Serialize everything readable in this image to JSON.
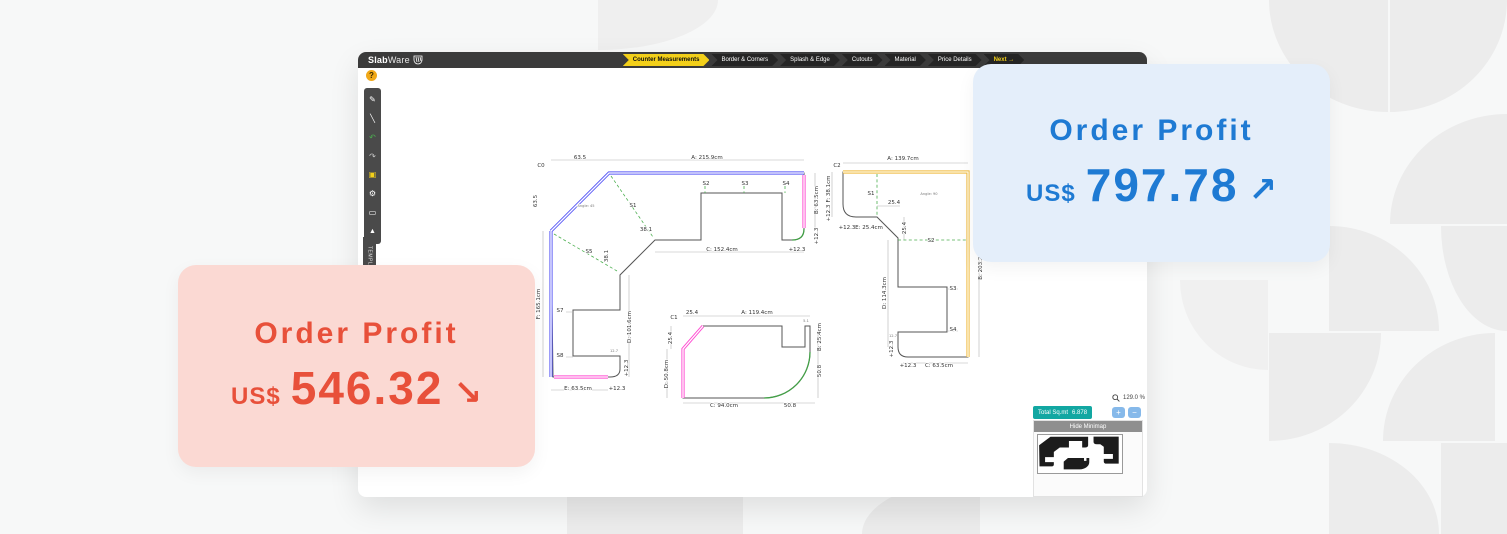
{
  "cards": {
    "red": {
      "title": "Order Profit",
      "currency": "US$",
      "amount": "546.32",
      "arrow": "↘"
    },
    "blue": {
      "title": "Order Profit",
      "currency": "US$",
      "amount": "797.78",
      "arrow": "↗"
    }
  },
  "topbar": {
    "logo_bold": "Slab",
    "logo_light": "Ware",
    "nav": [
      {
        "label": "Counter Measurements",
        "active": true
      },
      {
        "label": "Border & Corners",
        "active": false
      },
      {
        "label": "Splash & Edge",
        "active": false
      },
      {
        "label": "Cutouts",
        "active": false
      },
      {
        "label": "Material",
        "active": false
      },
      {
        "label": "Price Details",
        "active": false
      },
      {
        "label": "Next →",
        "active": false
      }
    ]
  },
  "toolbar": {
    "help": "?",
    "icons": [
      {
        "name": "pencil-icon",
        "glyph": "✎",
        "color": "#ffffff"
      },
      {
        "name": "draw-line-icon",
        "glyph": "╲",
        "color": "#ffffff"
      },
      {
        "name": "undo-icon",
        "glyph": "↶",
        "color": "#4caf50"
      },
      {
        "name": "redo-icon",
        "glyph": "↷",
        "color": "#cccccc"
      },
      {
        "name": "save-icon",
        "glyph": "▣",
        "color": "#f3d01a"
      },
      {
        "name": "settings-gear-icon",
        "glyph": "⚙",
        "color": "#ffffff"
      },
      {
        "name": "laptop-icon",
        "glyph": "▭",
        "color": "#ffffff"
      },
      {
        "name": "warning-icon",
        "glyph": "▲",
        "color": "#ffffff"
      }
    ]
  },
  "template_tab": "TEMPLATE",
  "controls": {
    "zoom_level": "129.0 %",
    "total_label": "Total Sq.mt",
    "total_value": "6.878",
    "zoom_in": "+",
    "zoom_out": "−",
    "minimap_header": "Hide Minimap"
  },
  "drawing": {
    "edge_colors": {
      "blue": "#5b5bf5",
      "pink": "#ff4dd2",
      "orange": "#efb93f",
      "green": "#43a047",
      "seam": "#4caf50"
    },
    "labels": [
      {
        "t": "C0",
        "x": 541,
        "y": 167
      },
      {
        "t": "63.5",
        "x": 580,
        "y": 159
      },
      {
        "t": "A: 215.9cm",
        "x": 707,
        "y": 159
      },
      {
        "t": "63.5",
        "x": 537,
        "y": 201,
        "r": -90
      },
      {
        "t": "F: 165.1cm",
        "x": 540,
        "y": 304,
        "r": -90
      },
      {
        "t": "Angle: 45",
        "x": 586,
        "y": 207,
        "tiny": true
      },
      {
        "t": "S1",
        "x": 633,
        "y": 207
      },
      {
        "t": "38.1",
        "x": 646,
        "y": 231
      },
      {
        "t": "S5",
        "x": 589,
        "y": 253
      },
      {
        "t": "38.1",
        "x": 608,
        "y": 256,
        "r": -90
      },
      {
        "t": "S2",
        "x": 706,
        "y": 185
      },
      {
        "t": "S3",
        "x": 745,
        "y": 185
      },
      {
        "t": "S4",
        "x": 786,
        "y": 185
      },
      {
        "t": "B: 63.5cm",
        "x": 818,
        "y": 200,
        "r": -90
      },
      {
        "t": "+12.3",
        "x": 818,
        "y": 236,
        "r": -90
      },
      {
        "t": "C: 152.4cm",
        "x": 722,
        "y": 251
      },
      {
        "t": "+12.3",
        "x": 797,
        "y": 251
      },
      {
        "t": "S7",
        "x": 560,
        "y": 312
      },
      {
        "t": "S8",
        "x": 560,
        "y": 357
      },
      {
        "t": "D: 101.6cm",
        "x": 631,
        "y": 327,
        "r": -90
      },
      {
        "t": "+12.3",
        "x": 628,
        "y": 368,
        "r": -90
      },
      {
        "t": "12.7",
        "x": 614,
        "y": 352,
        "tiny": true
      },
      {
        "t": "E: 63.5cm",
        "x": 578,
        "y": 390
      },
      {
        "t": "+12.3",
        "x": 617,
        "y": 390
      },
      {
        "t": "C1",
        "x": 674,
        "y": 319
      },
      {
        "t": "25.4",
        "x": 692,
        "y": 314
      },
      {
        "t": "A: 119.4cm",
        "x": 757,
        "y": 314
      },
      {
        "t": "5.1",
        "x": 806,
        "y": 322,
        "tiny": true
      },
      {
        "t": "25.4",
        "x": 672,
        "y": 338,
        "r": -90
      },
      {
        "t": "D: 50.8cm",
        "x": 668,
        "y": 374,
        "r": -90
      },
      {
        "t": "B: 25.4cm",
        "x": 821,
        "y": 337,
        "r": -90
      },
      {
        "t": "50.8",
        "x": 821,
        "y": 371,
        "r": -90
      },
      {
        "t": "C: 94.0cm",
        "x": 724,
        "y": 407
      },
      {
        "t": "50.8",
        "x": 790,
        "y": 407
      },
      {
        "t": "C2",
        "x": 837,
        "y": 167
      },
      {
        "t": "A: 139.7cm",
        "x": 903,
        "y": 160
      },
      {
        "t": "F: 38.1cm",
        "x": 830,
        "y": 189,
        "r": -90
      },
      {
        "t": "+12.3",
        "x": 830,
        "y": 213,
        "r": -90
      },
      {
        "t": "S1",
        "x": 871,
        "y": 195
      },
      {
        "t": "25.4",
        "x": 894,
        "y": 204
      },
      {
        "t": "Angle: 90",
        "x": 929,
        "y": 195,
        "tiny": true
      },
      {
        "t": "25.4",
        "x": 906,
        "y": 228,
        "r": -90
      },
      {
        "t": "+12.3",
        "x": 847,
        "y": 229
      },
      {
        "t": "E: 25.4cm",
        "x": 869,
        "y": 229
      },
      {
        "t": "S2",
        "x": 931,
        "y": 242
      },
      {
        "t": "D: 114.3cm",
        "x": 886,
        "y": 293,
        "r": -90
      },
      {
        "t": "S3",
        "x": 953,
        "y": 290
      },
      {
        "t": "S4",
        "x": 953,
        "y": 331
      },
      {
        "t": "12.7",
        "x": 893,
        "y": 337,
        "tiny": true
      },
      {
        "t": "+12.3",
        "x": 893,
        "y": 349,
        "r": -90
      },
      {
        "t": "B: 203.2cm",
        "x": 982,
        "y": 264,
        "r": -90
      },
      {
        "t": "+12.3",
        "x": 908,
        "y": 367
      },
      {
        "t": "C: 63.5cm",
        "x": 939,
        "y": 367
      }
    ]
  }
}
